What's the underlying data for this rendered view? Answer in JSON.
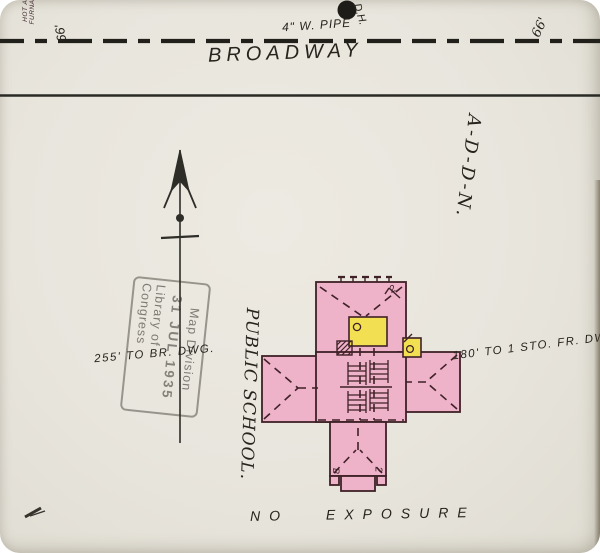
{
  "colors": {
    "paper": "#e8e5dd",
    "ink": "#26241d",
    "pink": "#eeb2c9",
    "outline": "#3f2127",
    "yellow": "#f2df52",
    "stamp": "#74726a"
  },
  "street": {
    "name": "BROADWAY",
    "pipe_label": "4\" W. PIPE",
    "hydrant_label": "D.H.",
    "width_left": "66'",
    "width_right": "66'"
  },
  "labels": {
    "addition": "A-D-D-N.",
    "school": "PUBLIC SCHOOL.",
    "distance_left": "255' TO BR. DWG.",
    "distance_right": "180' TO 1 STO. FR. DWG.",
    "furnace_line1": "HOT AIR",
    "furnace_line2": "FURNACE",
    "exposure": "NO  EXPOSURE"
  },
  "building": {
    "story_marker_top": "2",
    "story_marker_bottom_left": "B",
    "story_marker_bottom_right": "2"
  },
  "stamp": {
    "line1": "Map Division",
    "line2": "31 JUL 1935",
    "line3": "Library of Congress"
  }
}
